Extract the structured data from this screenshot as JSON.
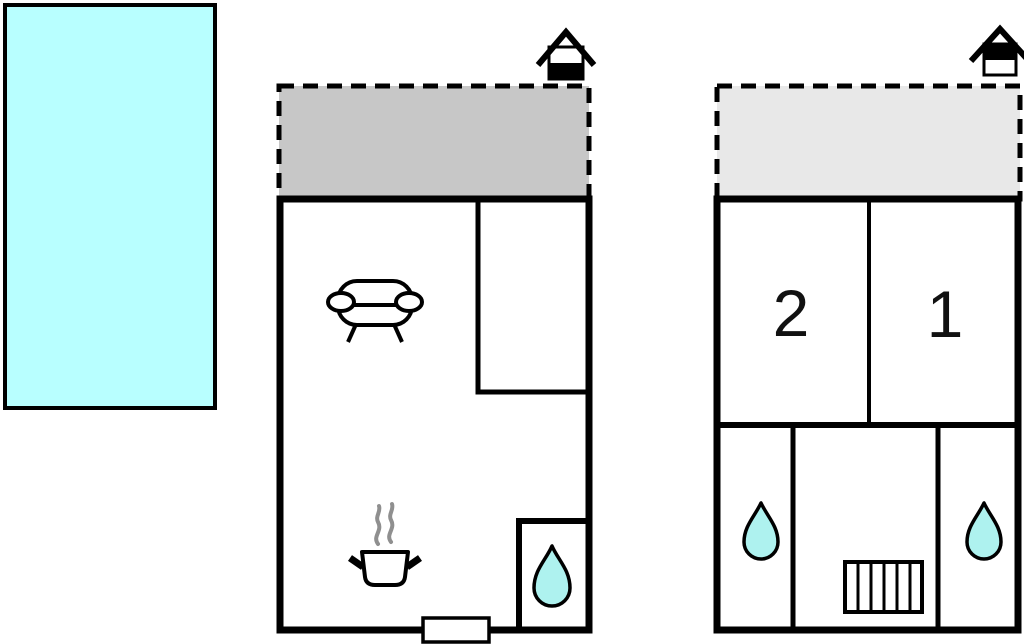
{
  "title": "holiday-home-floor-plan",
  "colors": {
    "pool_fill": "#b8ffff",
    "drop_fill": "#aef2ef",
    "terrace_ground_fill": "#c7c7c7",
    "terrace_upper_fill": "#e8e8e8",
    "wall": "#000000",
    "steam": "#8f8f8f",
    "room_number": "#111111"
  },
  "icons": {
    "pool": "swimming-pool",
    "sofa": "sofa-icon",
    "pot": "cooking-pot-icon",
    "water_drop": "water-drop-icon",
    "stairs": "stairs-icon",
    "entrance_ground": "house-icon-ground-floor",
    "entrance_upper": "house-icon-upper-floor"
  },
  "plans": {
    "upper": {
      "room2_label": "2",
      "room1_label": "1"
    }
  }
}
